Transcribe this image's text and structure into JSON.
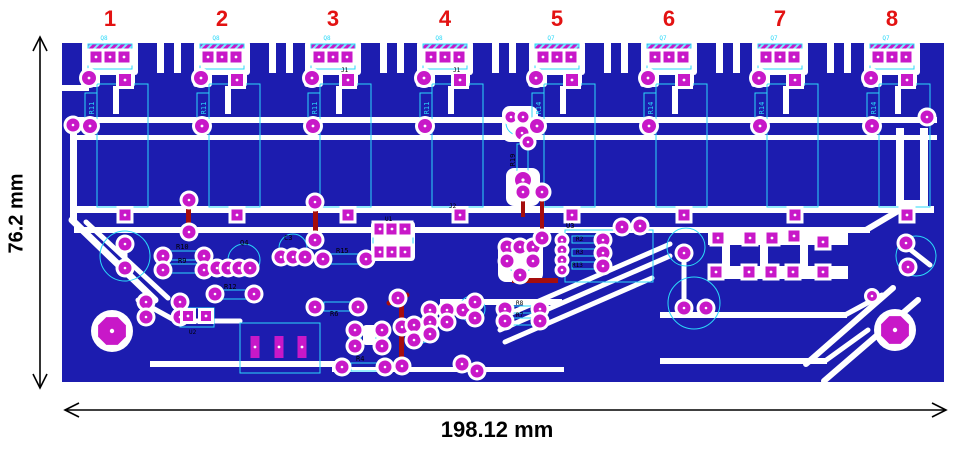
{
  "title": "PCB copper and silkscreen layout with board dimensions",
  "dimension_annotations": {
    "height_label": "76.2 mm",
    "width_label": "198.12 mm"
  },
  "channel_markers": [
    {
      "number": "1",
      "transistor_ref": "Q8",
      "resistor_ref": "R11"
    },
    {
      "number": "2",
      "transistor_ref": "Q8",
      "resistor_ref": "R11"
    },
    {
      "number": "3",
      "transistor_ref": "Q8",
      "resistor_ref": "R11"
    },
    {
      "number": "4",
      "transistor_ref": "Q8",
      "resistor_ref": "R11"
    },
    {
      "number": "5",
      "transistor_ref": "Q7",
      "resistor_ref": "R14"
    },
    {
      "number": "6",
      "transistor_ref": "Q7",
      "resistor_ref": "R14"
    },
    {
      "number": "7",
      "transistor_ref": "Q7",
      "resistor_ref": "R14"
    },
    {
      "number": "8",
      "transistor_ref": "Q7",
      "resistor_ref": "R14"
    }
  ],
  "silkscreen_labels": {
    "r19": "R19",
    "u3": "U3",
    "r2": "R2",
    "r3": "R3",
    "r13": "R13",
    "r10": "R10",
    "r9": "R9",
    "r12": "R12",
    "r15": "R15",
    "r6": "R6",
    "r4": "R4",
    "r7": "R7",
    "r8": "R8",
    "q4": "Q4",
    "c3": "C3",
    "u1": "U1",
    "u2": "U2",
    "j1": "J1",
    "j2": "J2"
  },
  "colors": {
    "board_substrate": "#1c1caf",
    "copper_trace": "#ffffff",
    "pad": "#c818c8",
    "silkscreen": "#2bd9f8",
    "jumper_wire": "#a50d0d",
    "channel_number": "#e31212",
    "dimension": "#000000"
  }
}
